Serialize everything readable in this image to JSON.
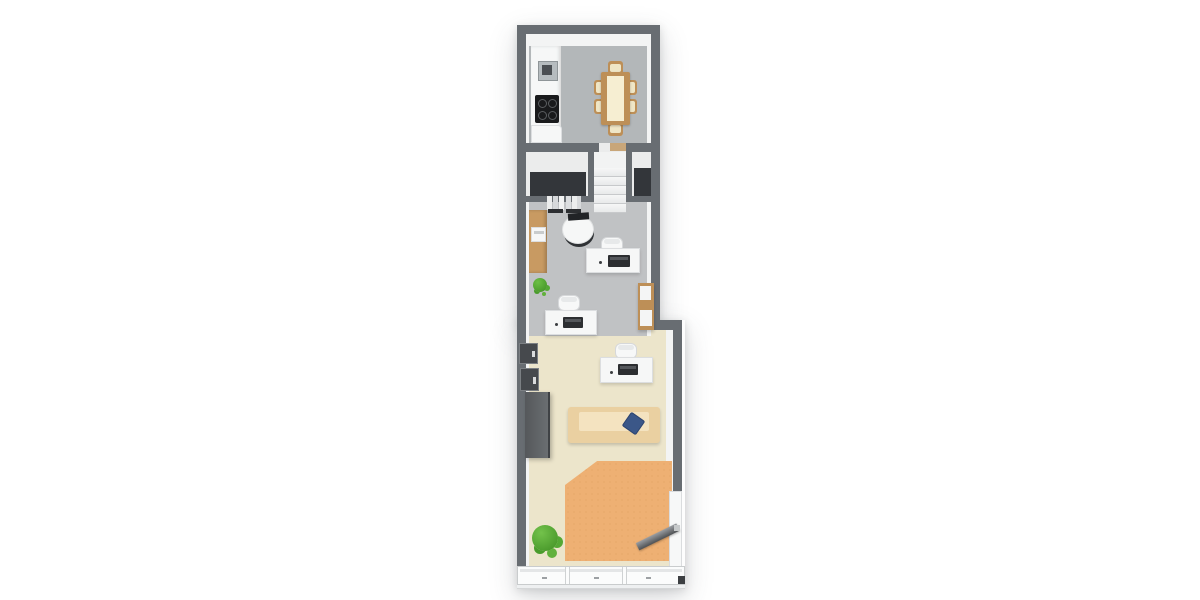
{
  "scene": {
    "description": "3D rendered top-down floor plan of a long narrow unit",
    "view": "top-down 3D render",
    "background": "#ffffff"
  },
  "palette": {
    "wall": "#686d72",
    "wall_dark": "#565a5e",
    "inner_wall": "#f3f4f4",
    "floor_kitchen": "#b3b7b9",
    "floor_office": "#c0c2c4",
    "floor_hall": "#ebecec",
    "floor_living": "#ece5cb",
    "closet_dark": "#33363a",
    "rug": "#eeb073",
    "rug_speckle": "#e0a060",
    "wood": "#bd8f57",
    "table_runner": "#f6eed2",
    "chair_cushion": "#efe6c6",
    "furniture_white": "#f6f7f7",
    "appliance_black": "#1a1b1d",
    "steel": "#b6bcbf",
    "sofa": "#ead0a1",
    "sofa_seat": "#f4e3c0",
    "pillow_blue": "#3b5788",
    "wardrobe_gray": "#5d6164",
    "plant_green": "#58a438",
    "door_gray": "#7d8185"
  },
  "rooms": {
    "kitchen": {
      "label": "Kitchen / dining"
    },
    "hall": {
      "label": "Hall with staircase and closets"
    },
    "office": {
      "label": "Office area"
    },
    "living": {
      "label": "Living / front area"
    }
  },
  "furniture": {
    "counter": {
      "label": "Kitchen counter"
    },
    "sink": {
      "label": "Sink"
    },
    "cooktop": {
      "label": "Cooktop with 4 burners"
    },
    "base_cabinet": {
      "label": "Base cabinet"
    },
    "dining_table": {
      "label": "Wooden dining table with runner"
    },
    "dining_chair": {
      "label": "Dining chair"
    },
    "stairs": {
      "label": "Staircase"
    },
    "threshold": {
      "label": "Wood threshold"
    },
    "closet_left": {
      "label": "Dark closet"
    },
    "closet_right": {
      "label": "Dark closet"
    },
    "coat_rack": {
      "label": "Coat rack with hanging clothes"
    },
    "sideboard": {
      "label": "Wooden sideboard"
    },
    "printer": {
      "label": "Printer"
    },
    "reception_desk": {
      "label": "Round reception desk with monitor"
    },
    "desk_office_1": {
      "label": "White desk with office chair and laptop"
    },
    "desk_office_2": {
      "label": "White desk with office chair and laptop"
    },
    "desk_living": {
      "label": "White desk with office chair and laptop"
    },
    "tall_cabinet": {
      "label": "Tall wooden cabinet"
    },
    "wall_niche": {
      "label": "Recessed wall unit"
    },
    "wardrobe": {
      "label": "Dark gray wardrobe"
    },
    "sofa": {
      "label": "Tan sofa"
    },
    "pillow": {
      "label": "Blue cushion"
    },
    "rug": {
      "label": "Orange area rug"
    },
    "plant_small": {
      "label": "Small plant"
    },
    "plant_large": {
      "label": "Large plant"
    },
    "entry_door": {
      "label": "Open entry door"
    },
    "storefront": {
      "label": "Glazed storefront with mullions"
    }
  }
}
